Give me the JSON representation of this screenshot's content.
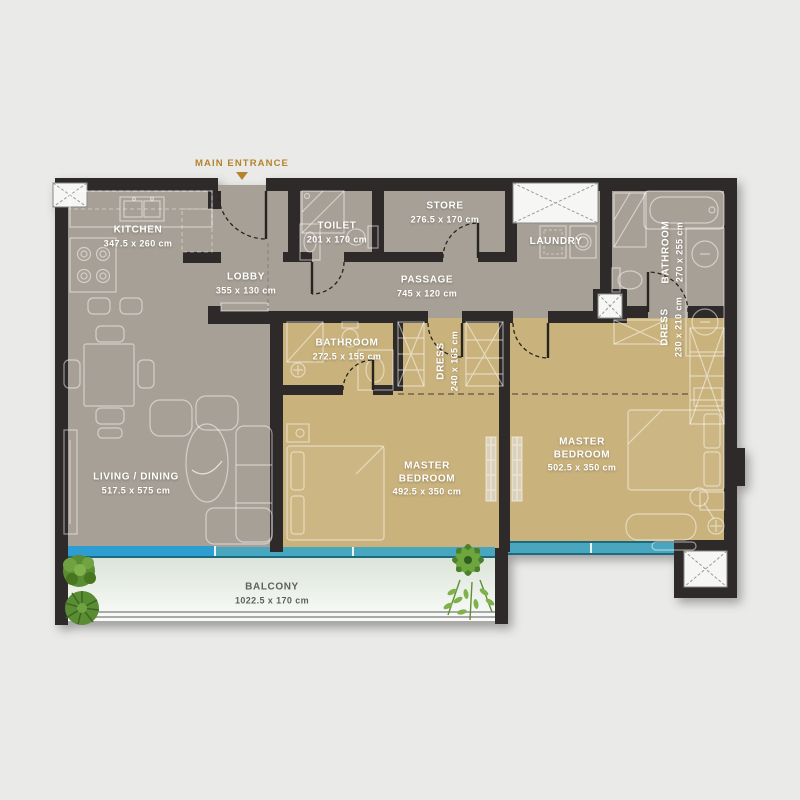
{
  "plan": {
    "entrance_label": "MAIN ENTRANCE",
    "rooms": {
      "kitchen": {
        "name": "KITCHEN",
        "dims": "347.5 x 260 cm"
      },
      "lobby": {
        "name": "LOBBY",
        "dims": "355 x 130 cm"
      },
      "toilet": {
        "name": "TOILET",
        "dims": "201 x 170 cm"
      },
      "store": {
        "name": "STORE",
        "dims": "276.5 x 170 cm"
      },
      "laundry": {
        "name": "LAUNDRY",
        "dims": ""
      },
      "passage": {
        "name": "PASSAGE",
        "dims": "745 x 120 cm"
      },
      "bathroom_main": {
        "name": "BATHROOM",
        "dims": "270 x 255 cm"
      },
      "bathroom_second": {
        "name": "BATHROOM",
        "dims": "272.5 x 155 cm"
      },
      "dress_first": {
        "name": "DRESS",
        "dims": "240 x 165 cm"
      },
      "dress_second": {
        "name": "DRESS",
        "dims": "230 x 210 cm"
      },
      "living_dining": {
        "name": "LIVING / DINING",
        "dims": "517.5 x 575 cm"
      },
      "master_bedroom_first": {
        "name": "MASTER BEDROOM",
        "dims": "492.5 x 350 cm"
      },
      "master_bedroom_second": {
        "name": "MASTER BEDROOM",
        "dims": "502.5 x 350 cm"
      },
      "balcony": {
        "name": "BALCONY",
        "dims": "1022.5 x 170 cm"
      }
    },
    "colors": {
      "background": "#eaeae8",
      "walls": "#2d2b29",
      "floor_common": "#a7a096",
      "floor_bedrooms": "#c9b27c",
      "balcony_top": "#d8e2d5",
      "balcony_bottom": "#fbfcfa",
      "window_glass": "#3399c2",
      "entrance_accent": "#b5832e",
      "label_text": "#ffffff",
      "balcony_label_text": "#5f5f5c"
    }
  }
}
